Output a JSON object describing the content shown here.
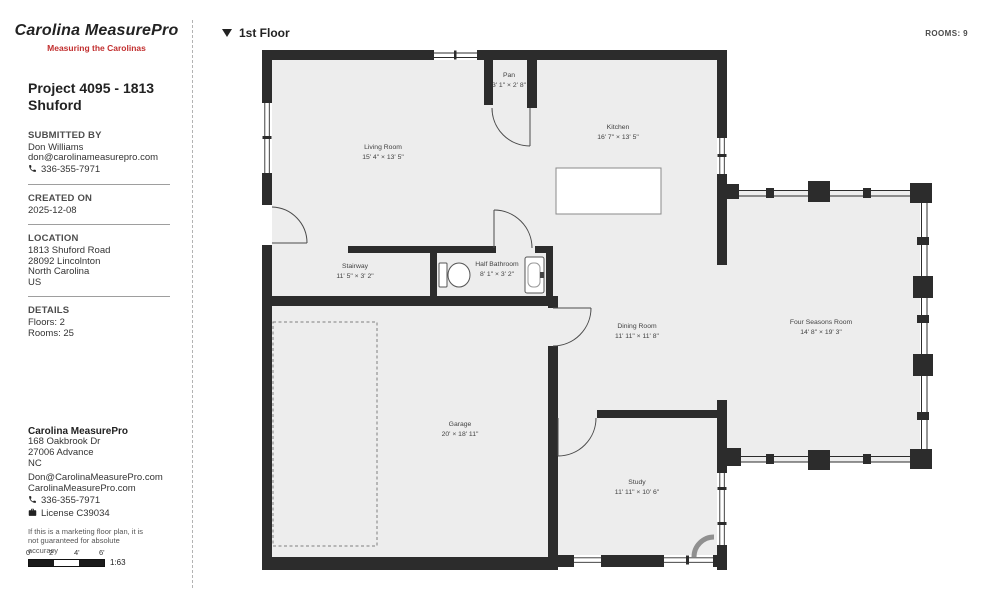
{
  "brand": {
    "logo": "Carolina MeasurePro",
    "tagline": "Measuring the Carolinas",
    "accent": "#c22f2f"
  },
  "header": {
    "floor_label": "1st Floor",
    "rooms_count_label": "ROOMS: 9"
  },
  "project": {
    "title": "Project 4095 - 1813 Shuford"
  },
  "submitted_by": {
    "label": "SUBMITTED BY",
    "name": "Don Williams",
    "email": "don@carolinameasurepro.com",
    "phone": "336-355-7971"
  },
  "created_on": {
    "label": "CREATED ON",
    "date": "2025-12-08"
  },
  "location": {
    "label": "LOCATION",
    "address_line": "1813 Shuford Road",
    "city_line": "28092 Lincolnton",
    "state_line": "North Carolina",
    "country_line": "US"
  },
  "details": {
    "label": "DETAILS",
    "floors": "Floors: 2",
    "rooms": "Rooms: 25"
  },
  "company": {
    "name": "Carolina MeasurePro",
    "address1": "168 Oakbrook Dr",
    "address2": "27006 Advance",
    "address3": "NC",
    "email": "Don@CarolinaMeasurePro.com",
    "website": "CarolinaMeasurePro.com",
    "phone": "336-355-7971",
    "license": "License C39034"
  },
  "disclaimer": "If this is a marketing floor plan, it is not guaranteed for absolute accuracy",
  "scale": {
    "ticks": [
      "0'",
      "2'",
      "4'",
      "6'"
    ],
    "ratio": "1:63"
  },
  "floorplan": {
    "rooms": [
      {
        "name": "Living Room",
        "dims": "15' 4\" × 13' 5\""
      },
      {
        "name": "Pan",
        "dims": "3' 1\" × 2' 8\""
      },
      {
        "name": "Kitchen",
        "dims": "16' 7\" × 13' 5\""
      },
      {
        "name": "Stairway",
        "dims": "11' 5\" × 3' 2\""
      },
      {
        "name": "Half Bathroom",
        "dims": "8' 1\" × 3' 2\""
      },
      {
        "name": "Dining Room",
        "dims": "11' 11\" × 11' 8\""
      },
      {
        "name": "Four Seasons Room",
        "dims": "14' 8\" × 19' 3\""
      },
      {
        "name": "Garage",
        "dims": "20' × 18' 11\""
      },
      {
        "name": "Study",
        "dims": "11' 11\" × 10' 6\""
      }
    ]
  }
}
